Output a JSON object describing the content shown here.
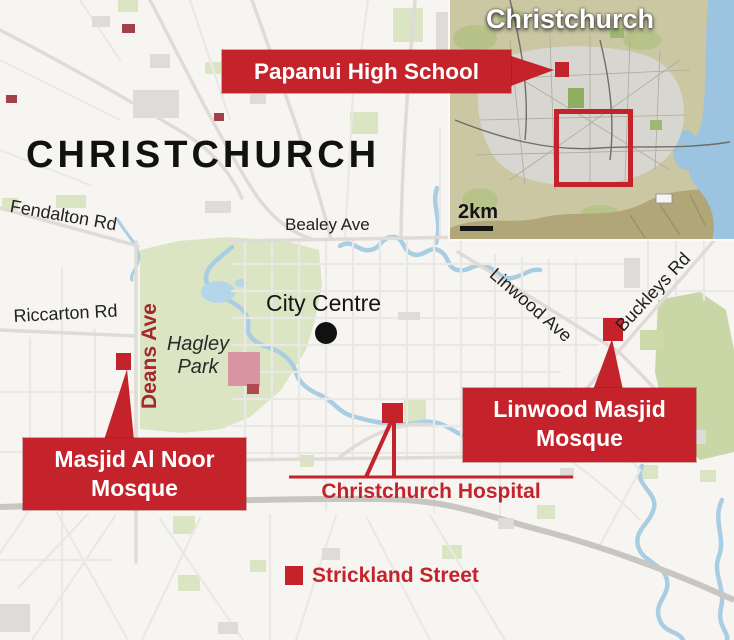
{
  "title": "CHRISTCHURCH",
  "streets": {
    "fendalton": "Fendalton Rd",
    "bealey": "Bealey Ave",
    "riccarton": "Riccarton Rd",
    "deans": "Deans Ave",
    "linwood": "Linwood Ave",
    "buckleys": "Buckleys Rd"
  },
  "places": {
    "city_centre": "City Centre",
    "hagley_line1": "Hagley",
    "hagley_line2": "Park"
  },
  "callouts": {
    "papanui": {
      "label": "Papanui High School"
    },
    "al_noor": {
      "line1": "Masjid Al Noor",
      "line2": "Mosque"
    },
    "linwood_masjid": {
      "line1": "Linwood Masjid",
      "line2": "Mosque"
    },
    "hospital": {
      "label": "Christchurch Hospital"
    },
    "strickland": {
      "label": "Strickland Street"
    }
  },
  "inset": {
    "title": "Christchurch",
    "scale_label": "2km"
  },
  "colors": {
    "callout_red": "#c5232b",
    "deans_street_red": "#a3292b",
    "map_background": "#f7f5f2",
    "park_green": "#dbe5c3",
    "river_blue": "#a9cee3",
    "railway_gray": "#c8c6c2",
    "inset_land_tan": "#cbc7a2",
    "inset_sea_blue": "#9cc4e0",
    "text_black": "#1d1d1b"
  }
}
